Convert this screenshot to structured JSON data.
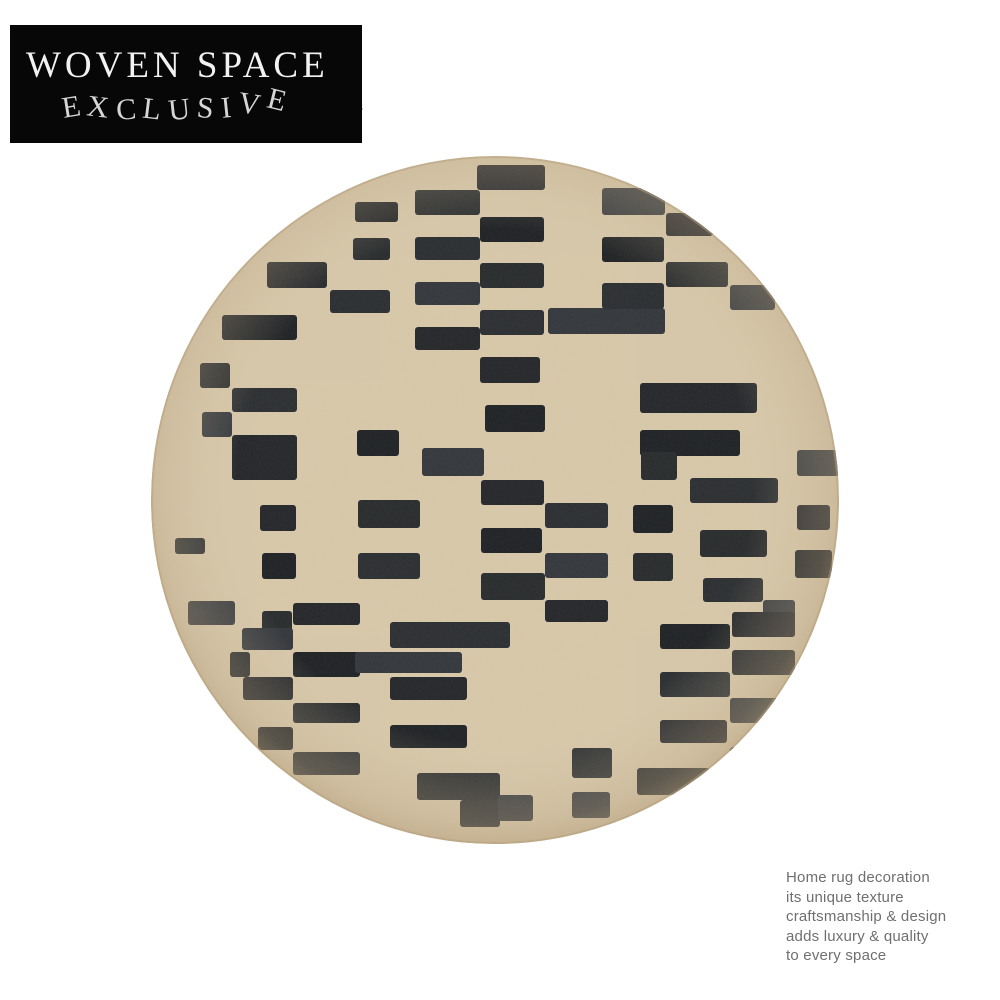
{
  "page": {
    "background": "#ffffff"
  },
  "badge": {
    "line1": "WOVEN SPACE",
    "line2": "EXCLUSIVE",
    "bg_color": "#070707",
    "line1_color": "#f2f2f2",
    "line2_color": "#d6d6d6"
  },
  "watermark": {
    "text": "n",
    "color": "#8d8d8d"
  },
  "caption": {
    "color": "#6f6f6f",
    "lines": [
      "Home rug decoration",
      "its unique texture",
      "craftsmanship & design",
      "adds luxury & quality",
      "to every space"
    ]
  },
  "rug": {
    "base_color": "#d8c8aa",
    "edge_color": "#b5a07c",
    "bar_colors": [
      "#24262a",
      "#2b2e31",
      "#1f2225",
      "#33373c",
      "#282b2d"
    ],
    "bars": [
      [
        327,
        10,
        68,
        25
      ],
      [
        330,
        62,
        64,
        25
      ],
      [
        330,
        108,
        64,
        25
      ],
      [
        330,
        155,
        64,
        25
      ],
      [
        398,
        153,
        117,
        26
      ],
      [
        330,
        202,
        60,
        26
      ],
      [
        335,
        250,
        60,
        27
      ],
      [
        265,
        35,
        65,
        25
      ],
      [
        265,
        82,
        65,
        23
      ],
      [
        265,
        127,
        65,
        23
      ],
      [
        265,
        172,
        65,
        23
      ],
      [
        205,
        47,
        43,
        20
      ],
      [
        203,
        83,
        37,
        22
      ],
      [
        180,
        135,
        60,
        23
      ],
      [
        452,
        33,
        63,
        27
      ],
      [
        516,
        58,
        47,
        23
      ],
      [
        452,
        82,
        62,
        25
      ],
      [
        516,
        107,
        62,
        25
      ],
      [
        452,
        128,
        62,
        26
      ],
      [
        580,
        130,
        45,
        25
      ],
      [
        117,
        107,
        60,
        26
      ],
      [
        72,
        160,
        75,
        25
      ],
      [
        50,
        208,
        30,
        25
      ],
      [
        82,
        233,
        65,
        24
      ],
      [
        52,
        257,
        30,
        25
      ],
      [
        82,
        280,
        65,
        45
      ],
      [
        207,
        275,
        42,
        26
      ],
      [
        208,
        345,
        62,
        28
      ],
      [
        208,
        398,
        62,
        26
      ],
      [
        272,
        293,
        62,
        28
      ],
      [
        110,
        350,
        36,
        26
      ],
      [
        112,
        398,
        34,
        26
      ],
      [
        112,
        456,
        30,
        26
      ],
      [
        25,
        383,
        30,
        16
      ],
      [
        38,
        446,
        47,
        24
      ],
      [
        143,
        448,
        67,
        22
      ],
      [
        143,
        497,
        67,
        25
      ],
      [
        143,
        548,
        67,
        20
      ],
      [
        143,
        597,
        67,
        23
      ],
      [
        92,
        473,
        51,
        22
      ],
      [
        93,
        522,
        50,
        23
      ],
      [
        108,
        572,
        35,
        23
      ],
      [
        80,
        497,
        20,
        25
      ],
      [
        240,
        467,
        120,
        26
      ],
      [
        205,
        497,
        107,
        21
      ],
      [
        240,
        522,
        77,
        23
      ],
      [
        240,
        570,
        77,
        23
      ],
      [
        267,
        618,
        83,
        27
      ],
      [
        310,
        645,
        40,
        27
      ],
      [
        348,
        640,
        35,
        26
      ],
      [
        331,
        325,
        63,
        25
      ],
      [
        331,
        373,
        61,
        25
      ],
      [
        331,
        418,
        64,
        27
      ],
      [
        395,
        348,
        63,
        25
      ],
      [
        395,
        398,
        63,
        25
      ],
      [
        395,
        445,
        63,
        22
      ],
      [
        483,
        350,
        40,
        28
      ],
      [
        483,
        398,
        40,
        28
      ],
      [
        422,
        593,
        40,
        30
      ],
      [
        422,
        637,
        38,
        26
      ],
      [
        490,
        228,
        117,
        30
      ],
      [
        490,
        275,
        100,
        26
      ],
      [
        491,
        297,
        36,
        28
      ],
      [
        540,
        323,
        88,
        25
      ],
      [
        647,
        295,
        45,
        26
      ],
      [
        647,
        350,
        33,
        25
      ],
      [
        645,
        395,
        37,
        28
      ],
      [
        550,
        375,
        67,
        27
      ],
      [
        553,
        423,
        60,
        24
      ],
      [
        613,
        445,
        32,
        23
      ],
      [
        582,
        457,
        63,
        25
      ],
      [
        510,
        469,
        70,
        25
      ],
      [
        582,
        495,
        63,
        25
      ],
      [
        510,
        517,
        70,
        25
      ],
      [
        580,
        543,
        63,
        25
      ],
      [
        510,
        565,
        67,
        23
      ],
      [
        580,
        592,
        57,
        25
      ],
      [
        487,
        613,
        73,
        27
      ]
    ]
  }
}
